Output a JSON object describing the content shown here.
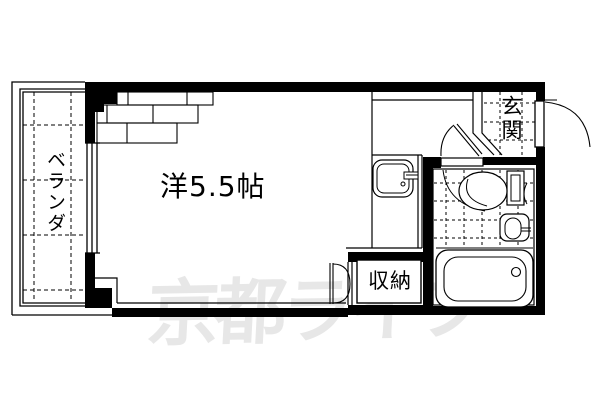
{
  "document": {
    "type": "apartment-floor-plan"
  },
  "labels": {
    "room": "洋5.5帖",
    "balcony": "ベランダ",
    "entrance": "玄関",
    "closet": "収納"
  },
  "watermark": {
    "text": "京都ライフ",
    "color": "#e7e7e7"
  },
  "colors": {
    "line": "#000000",
    "background": "#ffffff"
  },
  "fixtures": [
    "balcony-window",
    "kitchen-sink",
    "entrance-door",
    "interior-door",
    "bathroom-door",
    "closet-double-door",
    "toilet",
    "wash-basin",
    "bathtub"
  ]
}
